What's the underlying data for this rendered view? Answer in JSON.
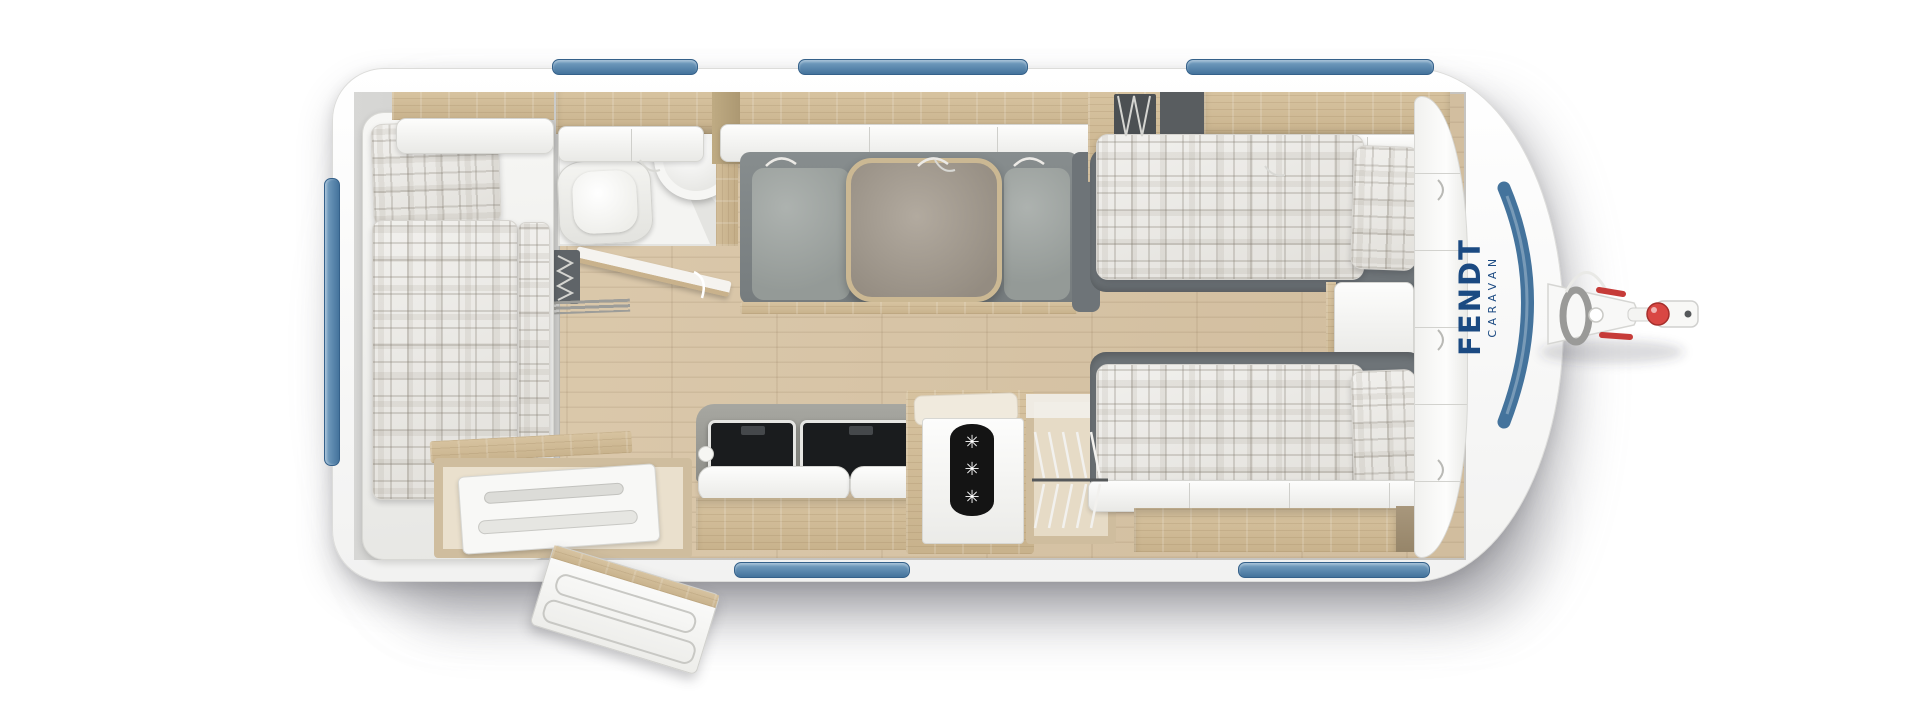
{
  "brand": {
    "name": "FENDT",
    "subtitle": "CARAVAN",
    "color": "#1b4a82"
  },
  "fridge": {
    "snowflake_glyph": "✳",
    "snowflake_count": 3
  },
  "palette": {
    "body_white": "#f9f9f8",
    "window_blue": "#44739c",
    "floor_wood": "#d7c5a7",
    "furniture_wood": "#cdbb9c",
    "upholstery_gray": "#858b8c",
    "bed_frame_gray": "#6e7478",
    "bedding_plaid": "#ececea",
    "backsplash_gray": "#9a9a94",
    "appliance_black": "#17191b",
    "hitch_red": "#d94743",
    "logo_blue": "#1b4a82"
  },
  "windows": {
    "blue_side_windows": 6,
    "front_panorama_window": 1
  },
  "elements": [
    "rear-french-bed",
    "rear-overhead-locker",
    "bathroom-toilet",
    "bathroom-washbasin",
    "bathroom-door",
    "bathroom-heater",
    "storage-bench",
    "entry-door-open",
    "overhead-lockers",
    "lounge-seating",
    "lounge-table",
    "kitchen-hob-lid",
    "kitchen-sink-lid",
    "kitchen-cabinet",
    "refrigerator",
    "wardrobe-with-hangers",
    "bed-head-heater",
    "single-bed-top",
    "single-bed-bottom",
    "nightstand",
    "front-overhead-lockers",
    "front-wardrobe-band",
    "tow-hitch"
  ]
}
